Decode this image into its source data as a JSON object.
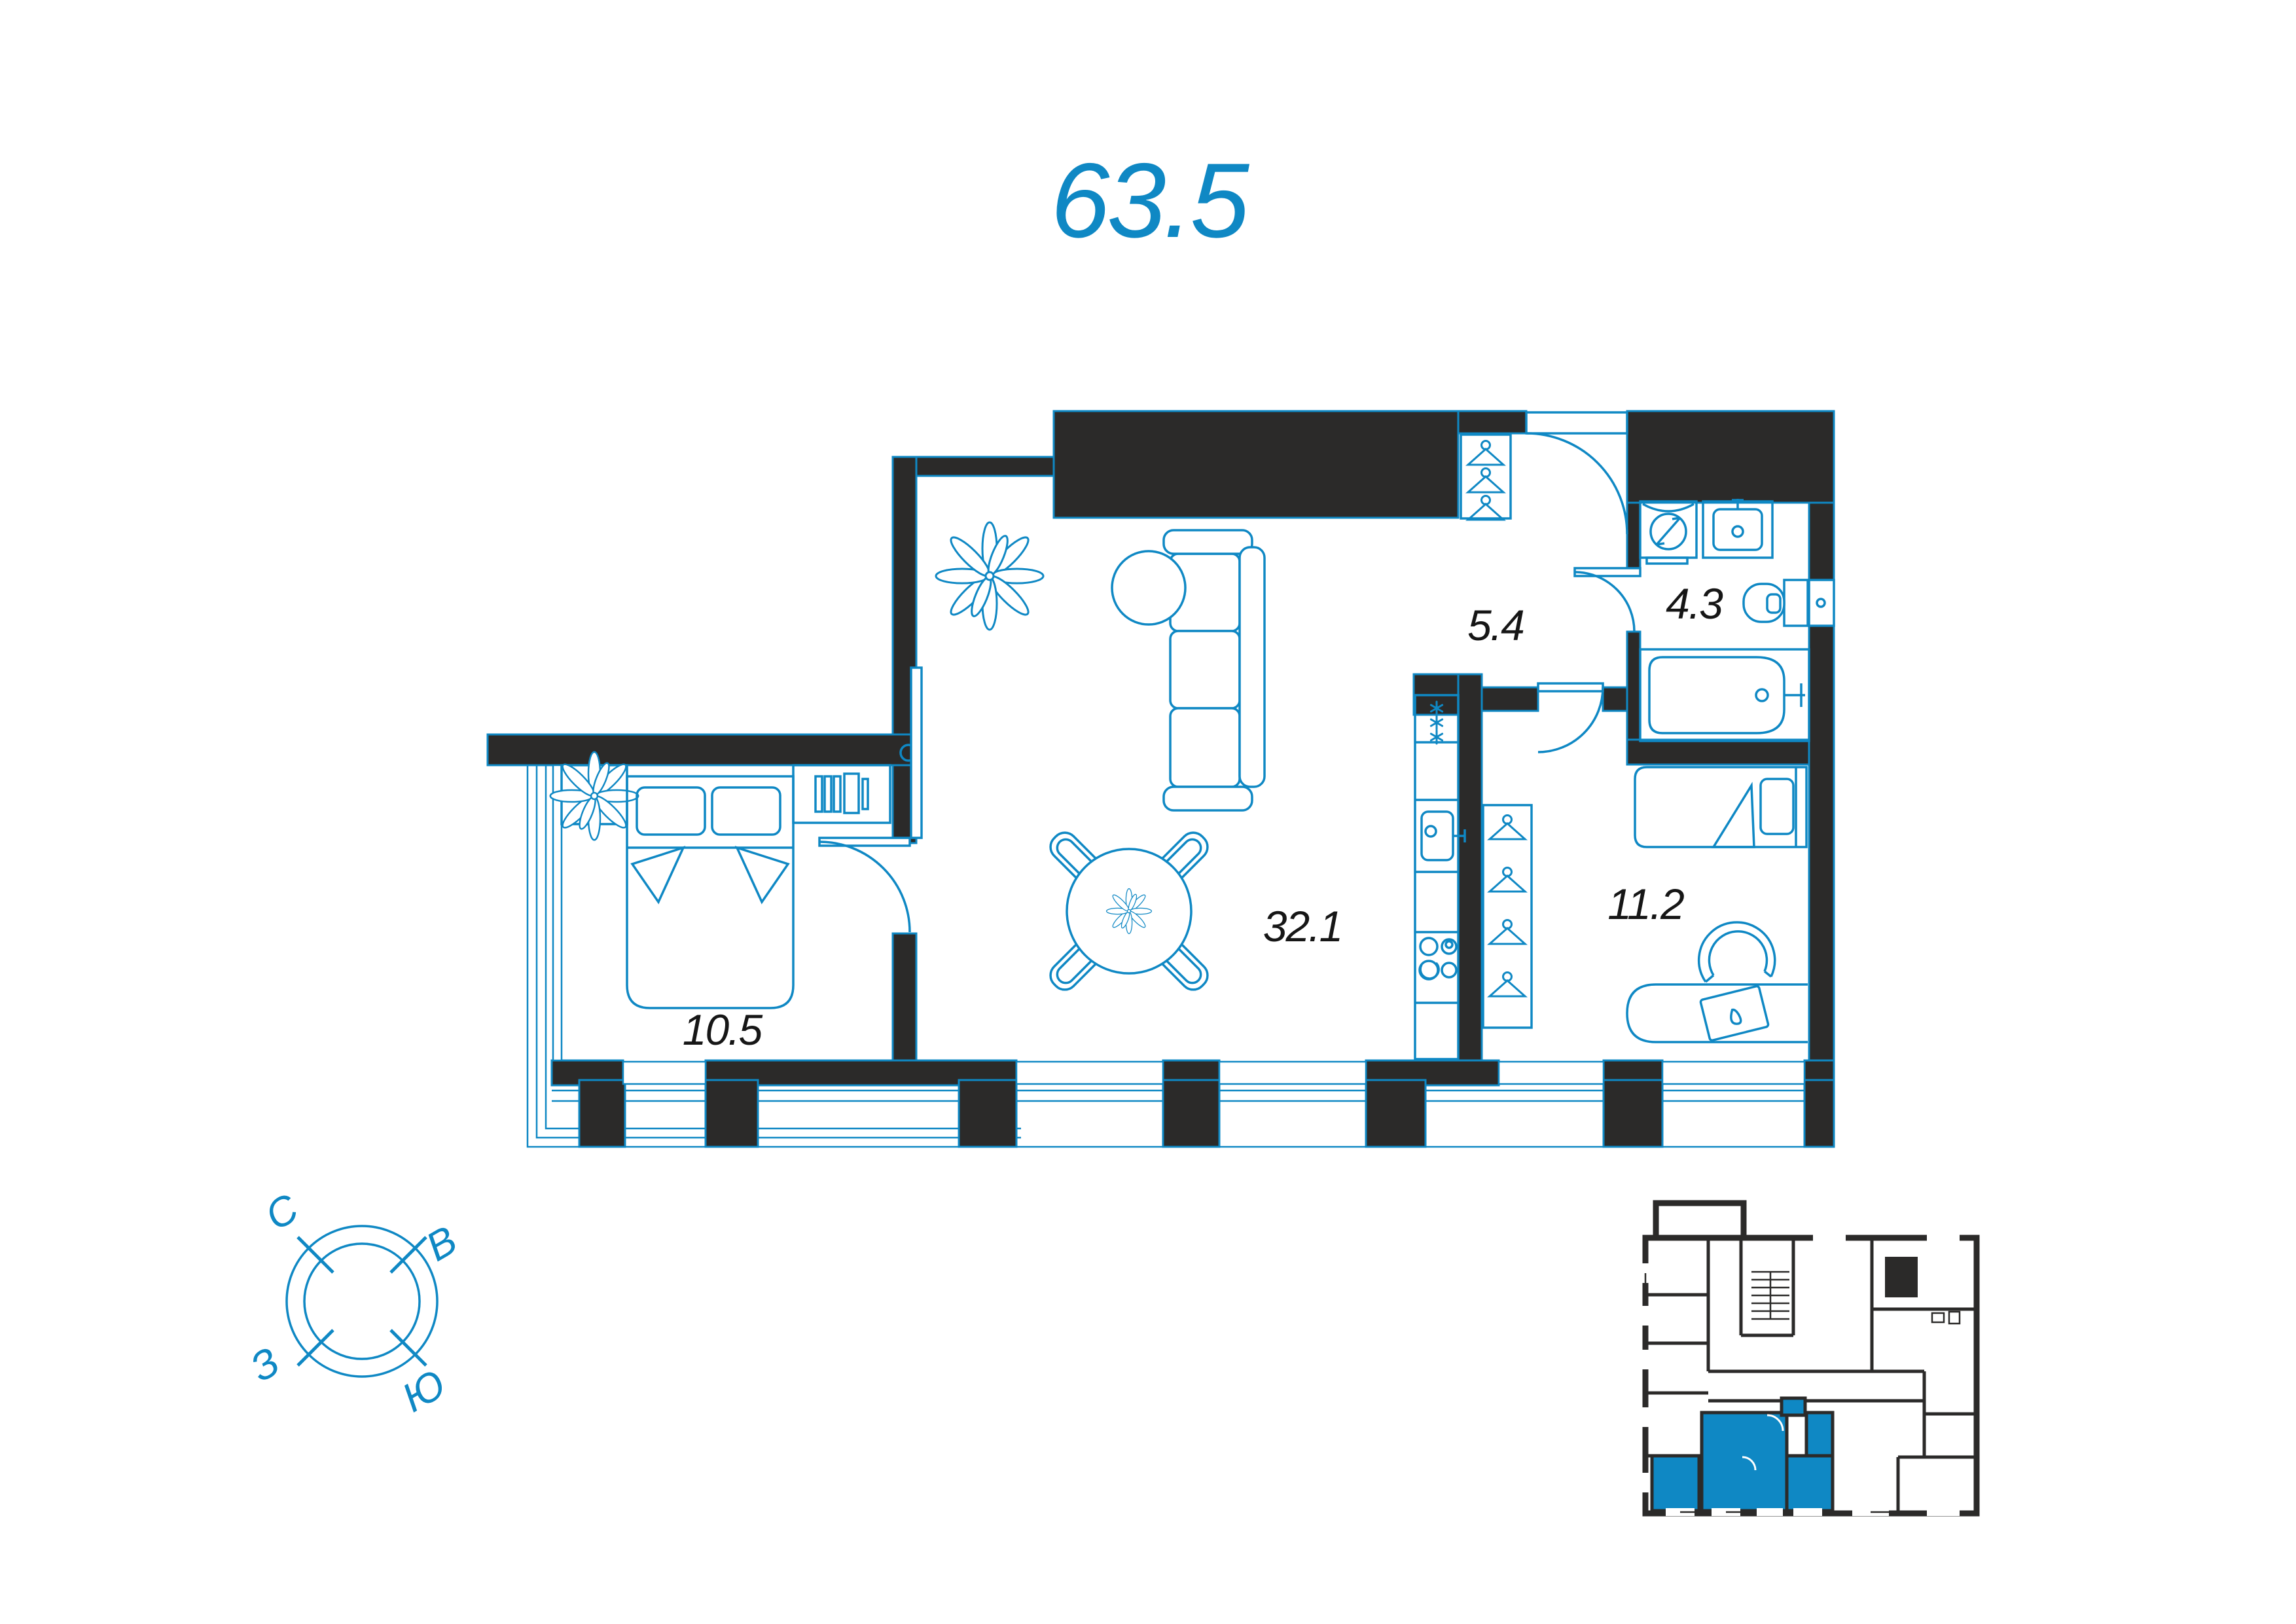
{
  "colors": {
    "accent_blue": "#0F88C4",
    "wall_black": "#2B2A29",
    "label_black": "#161616",
    "background": "#FFFFFF"
  },
  "header": {
    "total_area": "63.5"
  },
  "plan": {
    "rooms": [
      {
        "key": "living-kitchen",
        "area": "32.1"
      },
      {
        "key": "bedroom-main",
        "area": "10.5"
      },
      {
        "key": "bedroom-second",
        "area": "11.2"
      },
      {
        "key": "hallway",
        "area": "5.4"
      },
      {
        "key": "bathroom",
        "area": "4.3"
      }
    ],
    "furniture_icons": [
      "plant-icon",
      "tv-icon",
      "sofa-icon",
      "coffee-table-icon",
      "dining-table-icon",
      "dining-chair-icon",
      "fridge-icon",
      "kitchen-sink-icon",
      "stove-icon",
      "coat-rack-icon",
      "hanger-icon",
      "washing-machine-icon",
      "bathroom-sink-icon",
      "toilet-icon",
      "bathtub-icon",
      "double-bed-icon",
      "bookshelf-icon",
      "single-bed-icon",
      "desk-icon",
      "office-chair-icon",
      "laptop-icon"
    ]
  },
  "compass": {
    "north": "С",
    "east": "В",
    "west": "З",
    "south": "Ю"
  },
  "mini_plan": {
    "highlight_color": "#0F88C4"
  }
}
